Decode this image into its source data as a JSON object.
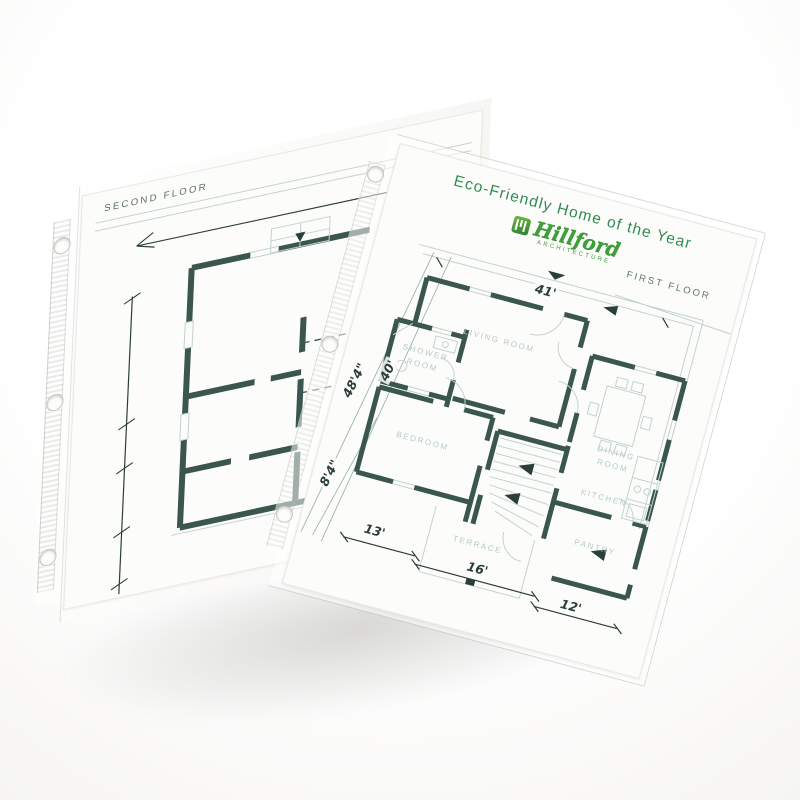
{
  "product": {
    "description": "Two overlapping top-loading sheet protectors holding architectural floor plans"
  },
  "front_sheet": {
    "title": "Eco-Friendly Home of the Year",
    "logo": {
      "name": "Hillford",
      "tagline": "ARCHITECTURE"
    },
    "floor_label": "FIRST FLOOR",
    "rooms": {
      "living": "LIVING ROOM",
      "shower": "SHOWER ROOM",
      "bedroom": "BEDROOM",
      "dining": "DINING ROOM",
      "kitchen": "KITCHEN",
      "pantry": "PANTRY",
      "terrace": "TERRACE"
    },
    "dimensions": {
      "top_width": "41'",
      "left_total": "48'4\"",
      "left_inner": "40'",
      "left_lower": "8'4\"",
      "bottom_left": "13'",
      "bottom_center": "16'",
      "bottom_right": "12'"
    }
  },
  "back_sheet": {
    "floor_label": "SECOND FLOOR"
  },
  "icons": {
    "logo_mark": "building-columns",
    "north_arrow": "down-triangle",
    "stair_arrows": "direction-triangles",
    "punch_holes": "three-ring-binder-holes"
  },
  "colors": {
    "background": "#ffffff",
    "title_green": "#2f8b51",
    "logo_green": "#3fa03a",
    "wall_dark": "#3a564f",
    "thin_line": "#c3d3cf",
    "room_label": "#b4cbc7",
    "dimension_text": "#2c3e39",
    "floor_label_text": "#5d766f"
  }
}
